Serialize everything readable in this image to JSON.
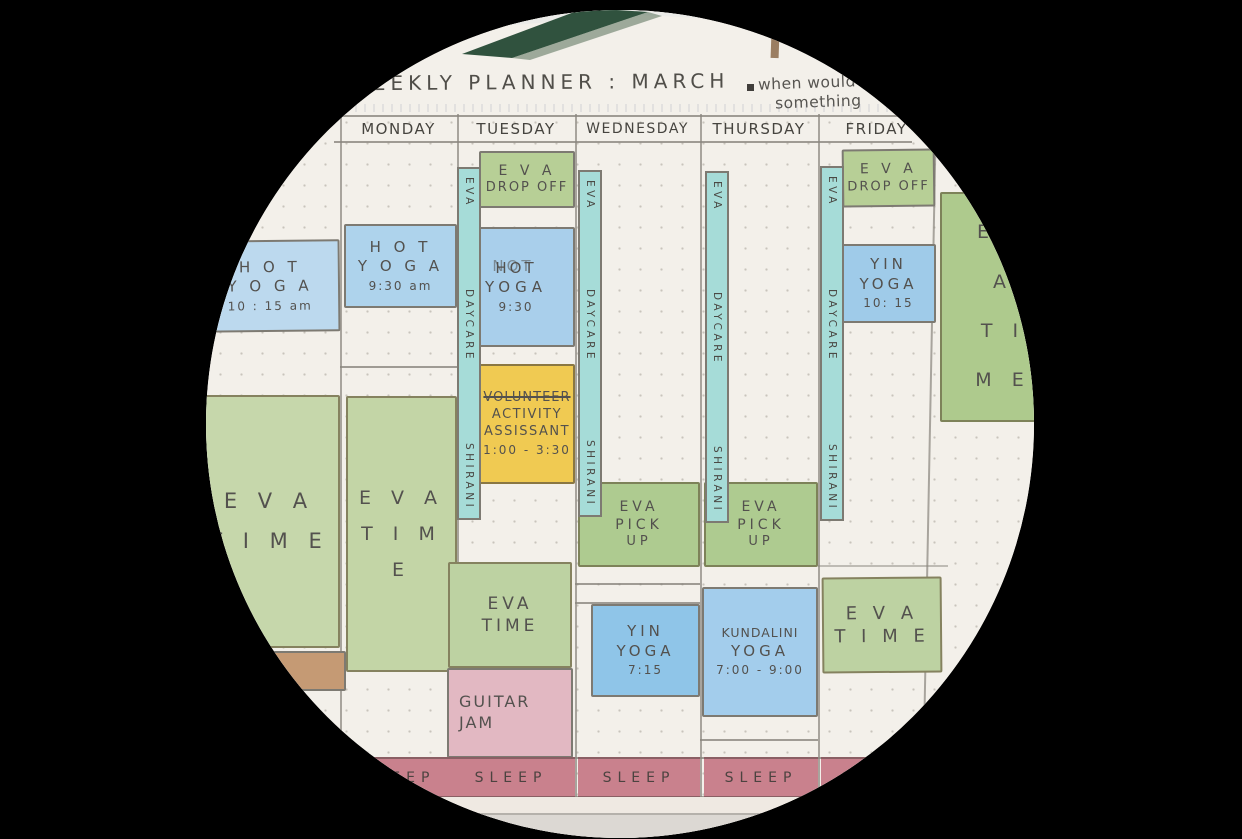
{
  "title": "WEEKLY PLANNER :   MARCH",
  "note": {
    "bullet": "",
    "line1": "when would",
    "line2": "something"
  },
  "header": {
    "days": [
      "MONDAY",
      "TUESDAY",
      "WEDNESDAY",
      "THURSDAY",
      "FRIDAY"
    ]
  },
  "daycare_strip": {
    "words": [
      "EVA",
      "DAYCARE",
      "SHIRANI"
    ]
  },
  "sleep_label": "SLEEP",
  "events": {
    "sun_hot_yoga": {
      "lines": [
        "H O T",
        "Y O G A"
      ],
      "time": "10 : 15 am"
    },
    "mon_hot_yoga": {
      "lines": [
        "H O T",
        "Y O G A"
      ],
      "time": "9:30 am"
    },
    "tue_drop_off": {
      "lines": [
        "E V A",
        "DROP OFF"
      ]
    },
    "tue_hot_yoga": {
      "lines": [
        "HOT",
        "YOGA"
      ],
      "time": "9:30",
      "overwritten": "NOT"
    },
    "tue_volunteer": {
      "struck": "VOLUNTEER",
      "lines": [
        "ACTIVITY",
        "ASSISSANT"
      ],
      "time": "1:00 - 3:30"
    },
    "sun_eva_time": {
      "lines": [
        "E V A",
        "T I M E"
      ]
    },
    "mon_eva_time": {
      "lines": [
        "E V A",
        "T I M E"
      ]
    },
    "tue_eva_time": {
      "lines": [
        "EVA",
        "TIME"
      ]
    },
    "wed_pick_up": {
      "lines": [
        "EVA",
        "PICK",
        "UP"
      ]
    },
    "thu_pick_up": {
      "lines": [
        "EVA",
        "PICK",
        "UP"
      ]
    },
    "wed_yin_yoga": {
      "lines": [
        "YIN",
        "YOGA"
      ],
      "time": "7:15"
    },
    "thu_kundalini": {
      "lines": [
        "KUNDALINI",
        "YOGA"
      ],
      "time": "7:00 - 9:00"
    },
    "fri_drop_off": {
      "lines": [
        "E V A",
        "DROP OFF"
      ]
    },
    "fri_yin_yoga": {
      "lines": [
        "YIN",
        "YOGA"
      ],
      "time": "10: 15"
    },
    "fri_eva_time": {
      "lines": [
        "E V A",
        "T I M E"
      ]
    },
    "sat_eva_time": {
      "lines": [
        "E V A",
        "T I M E"
      ]
    },
    "tue_guitar_jam": {
      "lines": [
        "GUITAR",
        "JAM"
      ]
    }
  },
  "colors": {
    "paper": "#f3f0ea",
    "pencil_text": "#53514e",
    "block_border": "#7d7a72",
    "green_event": "#b7cf96",
    "green_big": "#c3d5a6",
    "blue_event": "#aed3ec",
    "teal_strip": "#a6dcd8",
    "yellow_event": "#f0ca52",
    "pink_event": "#e2b8c2",
    "rose_sleep": "#c9818d",
    "brown_block": "#c59a74",
    "dark_green_band": "#30523e",
    "wall": "#ebebe8"
  }
}
